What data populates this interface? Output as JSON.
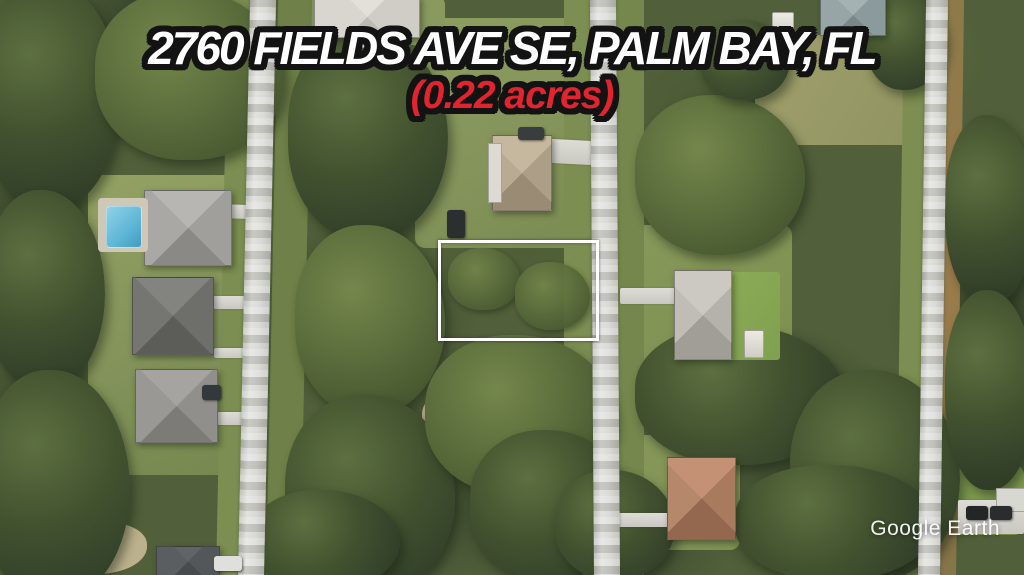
{
  "overlay": {
    "title": "2760 FIELDS AVE SE, PALM BAY, FL",
    "subtitle": "(0.22 acres)",
    "watermark": "Google Earth"
  },
  "colors": {
    "title-text": "#ffffff",
    "title-outline": "#131313",
    "subtitle-text": "#e2242f",
    "boundary": "#ffffff",
    "road": "#cfd0ca",
    "lawn": "#87975a",
    "trees-dark": "#34422a",
    "trees-mid": "#5d7040",
    "sand": "#c6b995",
    "pool": "#5fb6d6",
    "roof-gray": "#a3a29e",
    "roof-dark-gray": "#6b6c6a",
    "roof-tan": "#b0a289",
    "roof-terracotta": "#a87a5e",
    "roof-light": "#b5b2ab"
  }
}
